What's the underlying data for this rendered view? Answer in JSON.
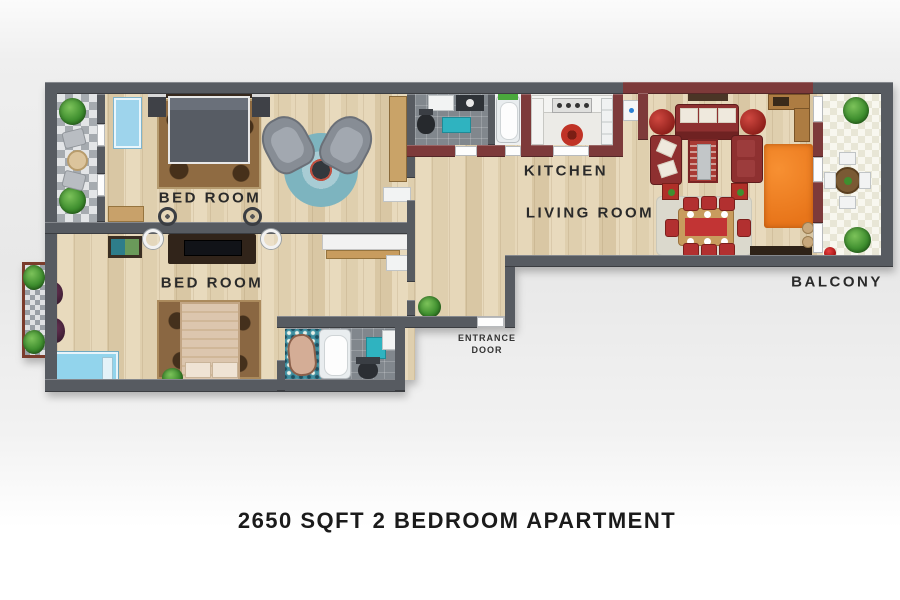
{
  "title": "2650 SQFT 2 BEDROOM APARTMENT",
  "labels": {
    "bedroom1": "BED ROOM",
    "bedroom2": "BED ROOM",
    "kitchen": "KITCHEN",
    "living_room": "LIVING ROOM",
    "balcony": "BALCONY",
    "entrance_line1": "ENTRANCE",
    "entrance_line2": "DOOR"
  },
  "colors": {
    "wall": "#575b61",
    "maroon_wall": "#7d3a3a",
    "sofa_red": "#8e3030",
    "dining_chair_red": "#b23030",
    "orange_rug": "#e8751a",
    "teal_accent": "#2fb3c0",
    "wood_floor": "#e3d4b6",
    "plant_green": "#3f8f2f",
    "text": "#1b1b1b"
  }
}
